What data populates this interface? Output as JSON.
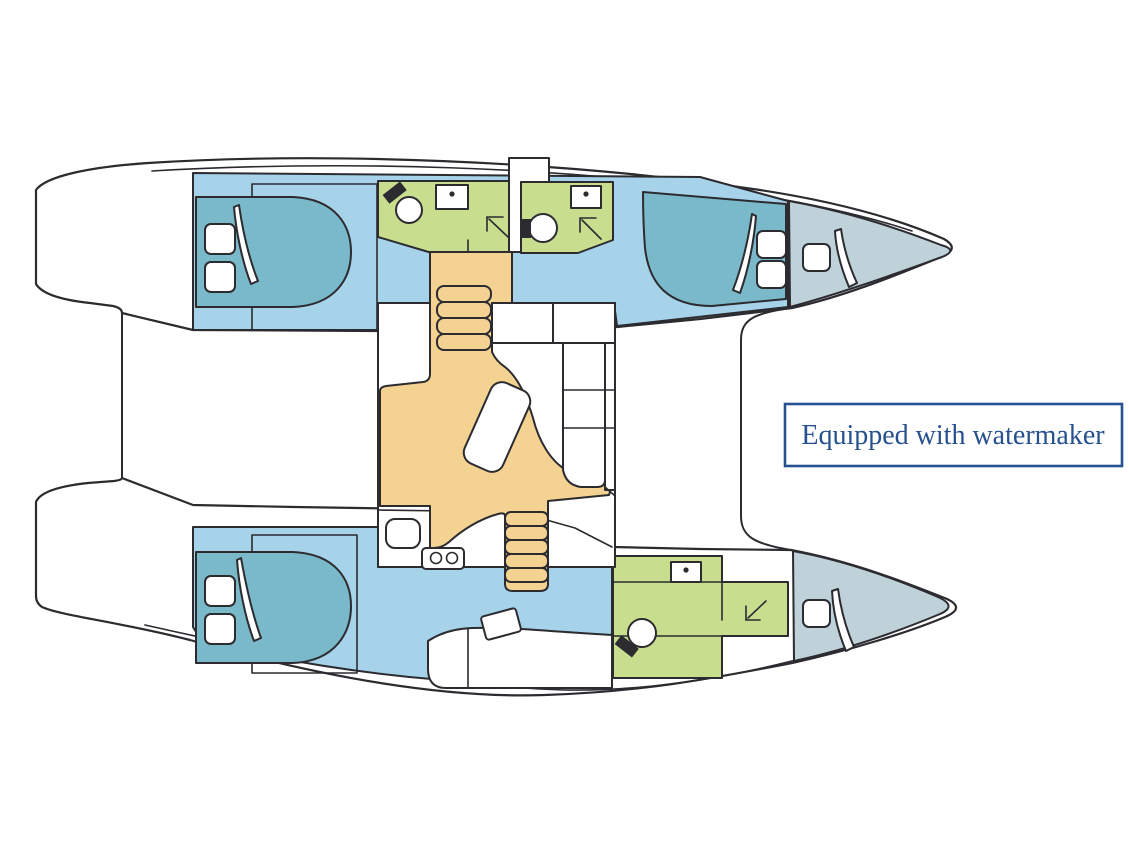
{
  "annotation": {
    "label": "Equipped with watermaker"
  },
  "colors": {
    "background": "#ffffff",
    "outline": "#2b2b30",
    "cabin-floor": "#a6d3e9",
    "bed": "#7ab9c9",
    "bathroom": "#c9dd8e",
    "salon-floor": "#f3d292",
    "forepeak": "#bfd1d9",
    "furniture": "#ffffff",
    "annotation-accent": "#26508f"
  },
  "icons": {
    "toilet-icon": "circle-with-black-lid",
    "sink-icon": "rectangle-with-drain-dot",
    "shower-icon": "corner-arrow",
    "hatch-icon": "rounded-square",
    "door-swing-icon": "curved-wedge",
    "stove-icon": "two-burner-circles",
    "stairs-icon": "stacked-steps",
    "table-icon": "rounded-rectangle",
    "sofa-icon": "segmented-bench"
  }
}
